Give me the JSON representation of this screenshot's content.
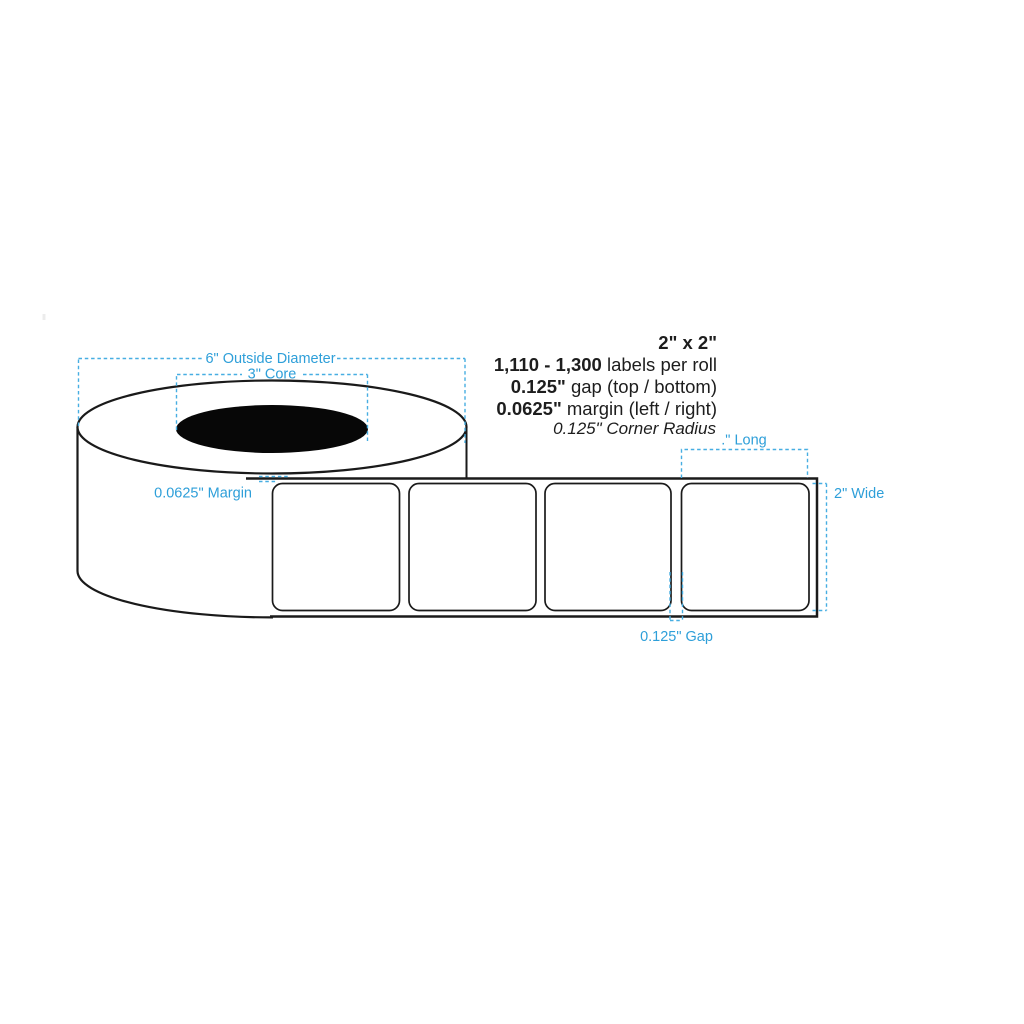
{
  "specs": {
    "size": "2\" x 2\"",
    "quantity_value": "1,110 - 1,300",
    "quantity_suffix": " labels per roll",
    "gap_value": "0.125\"",
    "gap_suffix": " gap (top / bottom)",
    "margin_value": "0.0625\"",
    "margin_suffix": " margin (left / right)",
    "corner_radius": "0.125\" Corner Radius"
  },
  "annotations": {
    "outside_diameter": "6\" Outside Diameter",
    "core": "3\" Core",
    "margin": "0.0625\" Margin",
    "long": ".\" Long",
    "wide": "2\" Wide",
    "gap": "0.125\" Gap"
  },
  "roll": {
    "visible_label_count": 4
  },
  "colors": {
    "annotation_blue": "#2E9FD9",
    "dash_blue": "#47AEE2",
    "diagram_line": "#1a1a1a",
    "core_fill": "#070707",
    "background": "#ffffff"
  }
}
